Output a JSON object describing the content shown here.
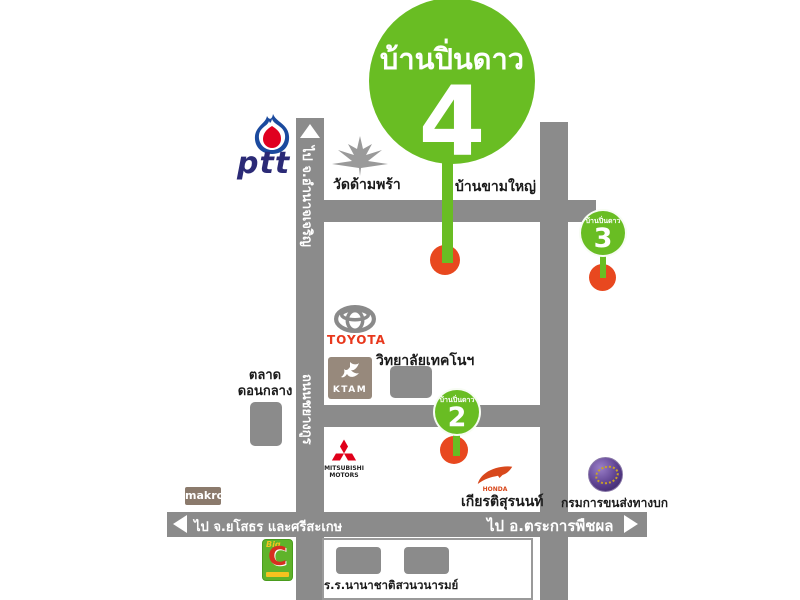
{
  "colors": {
    "green": "#69bd23",
    "red": "#e8481f",
    "road": "#8b8b8b",
    "box_gray": "#8b8b8b",
    "ptt_blue": "#1b4a9e",
    "ptt_navy": "#2b2a76",
    "ptt_red": "#e00020",
    "toyota_red": "#e8381d",
    "toyota_gray": "#8a8a8a",
    "mitsubishi_red": "#e0001a",
    "honda_red": "#d8481c",
    "ktam_brown": "#97897c",
    "makro_brown": "#8b7a6c",
    "bigc_green": "#5fb32a",
    "bigc_red": "#d62f1f",
    "bigc_yellow": "#f5c21f",
    "dlt_purple": "#5b3f8e",
    "temple_gray": "#9a9a9a"
  },
  "pins": {
    "pin4": {
      "label": "บ้านปิ่นดาว",
      "number": "4"
    },
    "pin3": {
      "label": "บ้านปิ่นดาว",
      "number": "3"
    },
    "pin2": {
      "label": "บ้านปิ่นดาว",
      "number": "2"
    }
  },
  "roads": {
    "north_direction": "ไป จ.อำนาจเจริญ",
    "road_name": "ถนนชยางกูร",
    "west_direction": "ไป จ.ยโสธร และศรีสะเกษ",
    "east_direction": "ไป อ.ตระการพืชผล"
  },
  "landmarks": {
    "ptt": "ptt",
    "temple": "วัดด้ามพร้า",
    "village": "บ้านขามใหญ่",
    "toyota": "TOYOTA",
    "college": "วิทยาลัยเทคโนฯ",
    "ktam": "KTAM",
    "market_line1": "ตลาด",
    "market_line2": "ดอนกลาง",
    "mitsubishi_line1": "MITSUBISHI",
    "mitsubishi_line2": "MOTORS",
    "honda_brand": "HONDA",
    "honda_dealer": "เกียรติสุรนนท์",
    "dlt": "กรมการขนส่งทางบก",
    "makro": "makro",
    "bigc_big": "Big",
    "bigc_c": "C",
    "school": "ร.ร.นานาชาติ",
    "park": "สวนวนารมย์"
  }
}
